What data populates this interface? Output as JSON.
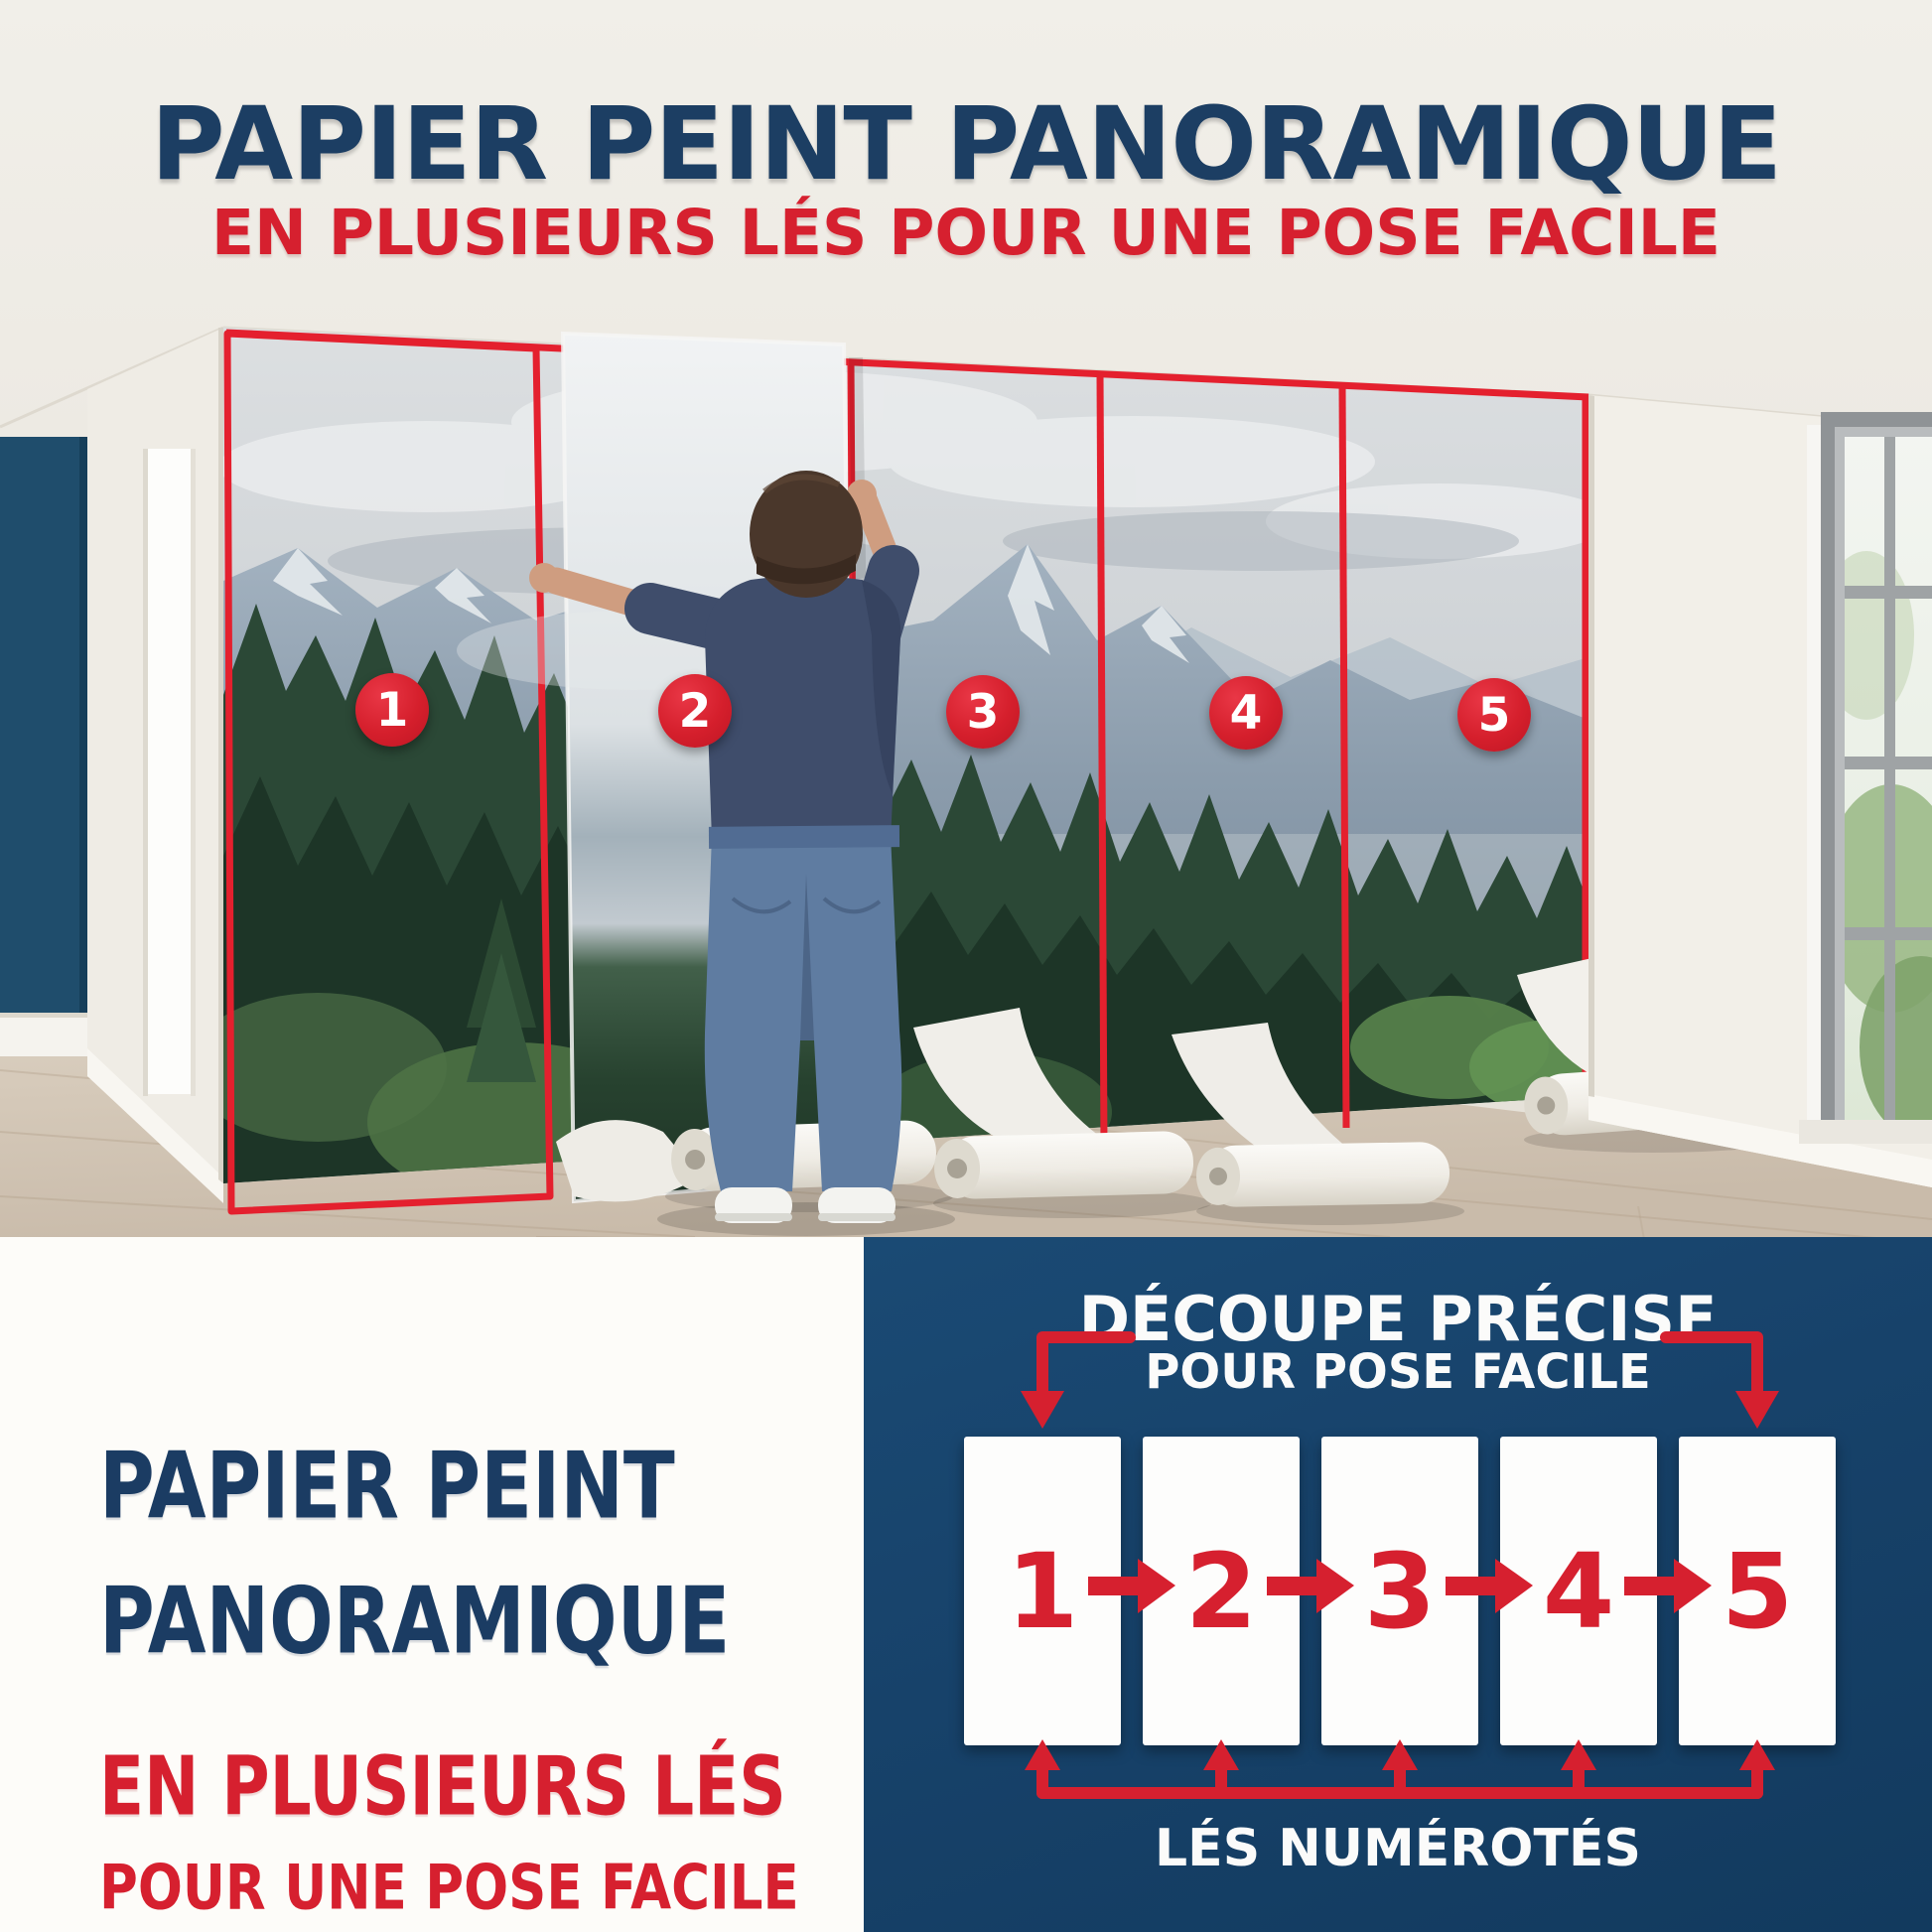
{
  "colors": {
    "navy_text": "#1b3c63",
    "red_accent": "#d6202f",
    "diagram_panel_navy": "#17426a",
    "accent_wall_navy": "#1f4d6c"
  },
  "header": {
    "title": "PAPIER PEINT PANORAMIQUE",
    "subtitle": "EN PLUSIEURS LÉS POUR UNE POSE FACILE"
  },
  "photo_labels": {
    "strips": [
      "1",
      "2",
      "3",
      "4",
      "5"
    ]
  },
  "bottom_left": {
    "title_line1": "PAPIER PEINT",
    "title_line2": "PANORAMIQUE",
    "subtitle_line1": "EN PLUSIEURS LÉS",
    "subtitle_line2": "POUR UNE POSE FACILE"
  },
  "diagram": {
    "title_line1": "DÉCOUPE PRÉCISE",
    "title_line2": "POUR POSE FACILE",
    "caption": "LÉS NUMÉROTÉS",
    "strips": [
      "1",
      "2",
      "3",
      "4",
      "5"
    ]
  }
}
